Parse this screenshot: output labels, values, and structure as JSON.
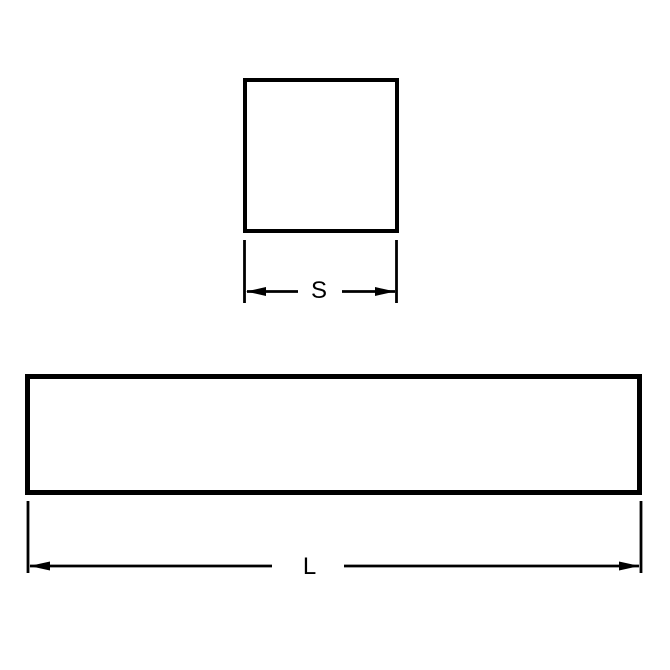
{
  "diagram": {
    "colors": {
      "background": "#ffffff",
      "line": "#000000"
    },
    "square_view": {
      "dimension_label": "S"
    },
    "side_view": {
      "dimension_label": "L"
    }
  }
}
